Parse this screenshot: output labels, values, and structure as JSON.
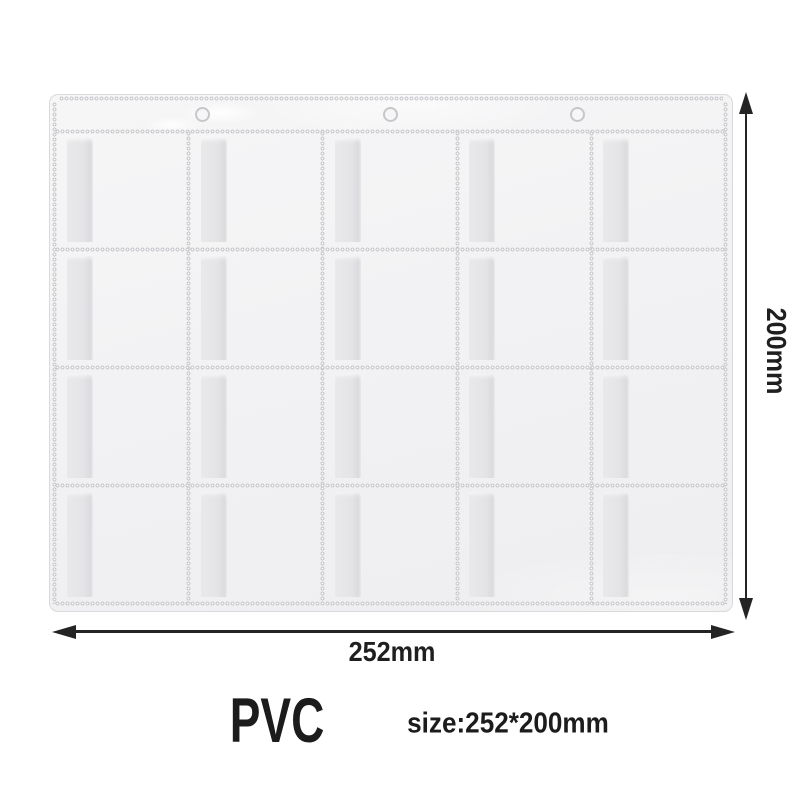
{
  "page": {
    "background": "#ffffff"
  },
  "product": {
    "description": "clear PVC multi-pocket binder sheet",
    "grid": {
      "rows": 4,
      "columns": 5,
      "pocket_count": 20
    },
    "binder_hole_count": 3
  },
  "dimensions": {
    "width": {
      "label": "252mm"
    },
    "height": {
      "label": "200mm"
    }
  },
  "footer": {
    "material_label": "PVC",
    "size_label": "size:252*200mm"
  },
  "colors": {
    "arrow": "#242424",
    "text": "#1c1c1c",
    "sheet_fill": "#f3f3f5",
    "sheet_border": "#d9d9db",
    "stitch": "#c9c9cd",
    "pocket_flap": "#e4e4e7"
  }
}
